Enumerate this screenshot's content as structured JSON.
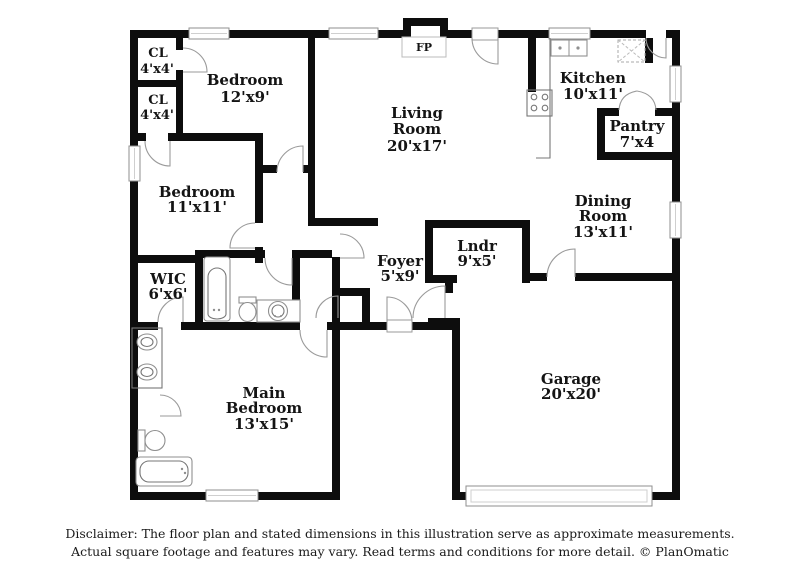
{
  "plan": {
    "fp_label": "FP",
    "rooms": {
      "cl1": {
        "name": "CL",
        "dims": "4'x4'"
      },
      "cl2": {
        "name": "CL",
        "dims": "4'x4'"
      },
      "bedroom12": {
        "name": "Bedroom",
        "dims": "12'x9'"
      },
      "living": {
        "line1": "Living",
        "line2": "Room",
        "dims": "20'x17'"
      },
      "kitchen": {
        "name": "Kitchen",
        "dims": "10'x11'"
      },
      "pantry": {
        "name": "Pantry",
        "dims": "7'x4"
      },
      "dining": {
        "line1": "Dining",
        "line2": "Room",
        "dims": "13'x11'"
      },
      "bedroom11": {
        "name": "Bedroom",
        "dims": "11'x11'"
      },
      "wic": {
        "name": "WIC",
        "dims": "6'x6'"
      },
      "foyer": {
        "name": "Foyer",
        "dims": "5'x9'"
      },
      "laundry": {
        "name": "Lndr",
        "dims": "9'x5'"
      },
      "main_bedroom": {
        "line1": "Main",
        "line2": "Bedroom",
        "dims": "13'x15'"
      },
      "garage": {
        "name": "Garage",
        "dims": "20'x20'"
      }
    }
  },
  "disclaimer": {
    "line1": "Disclaimer: The floor plan and stated dimensions in this illustration serve as approximate measurements.",
    "line2": "Actual square footage and features may vary. Read terms and conditions for more detail. © PlanOmatic"
  },
  "colors": {
    "wall": "#0d0d0d",
    "fixture_outline": "#8f8f8f",
    "door_arc": "#9a9a9a",
    "text": "#141414",
    "background": "#ffffff"
  }
}
